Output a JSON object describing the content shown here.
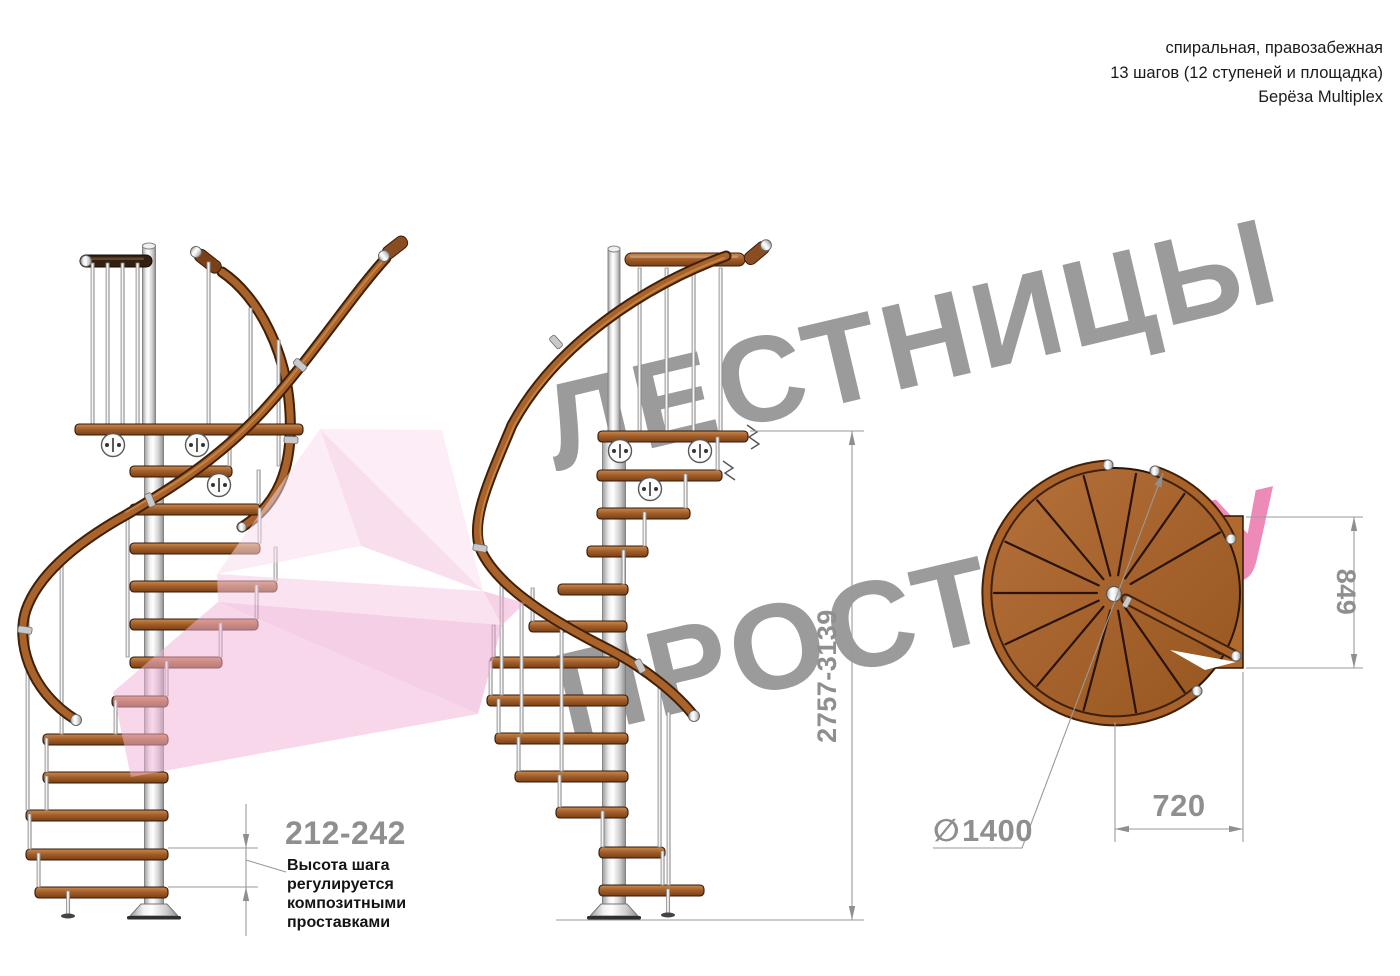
{
  "title_block": {
    "line1": "спиральная, правозабежная",
    "line2": "13 шагов (12 ступеней и площадка)",
    "line3": "Берёза Multiplex"
  },
  "watermark": {
    "word1": "ЛЕСТНИЦЫ",
    "word2": "ПРОСТО",
    "word2_suffix": ".РУ"
  },
  "annotations": {
    "total_height_range": "2757-3139",
    "step_height_range": "212-242",
    "step_height_note_lines": [
      "Высота шага",
      "регулируется",
      "композитными",
      "проставками"
    ],
    "landing_depth": "849",
    "landing_width": "720",
    "diameter_symbol": "∅",
    "diameter_value": "1400"
  },
  "colors": {
    "wood": "#a9622a",
    "wood_dark": "#30180a",
    "metal": "#d9d9d9",
    "dimension_gray": "#8f8f8f",
    "watermark_gray": "#9b9b9b",
    "watermark_pink": "#ee8ab8",
    "arrow_pink": "#f2b3d8"
  }
}
